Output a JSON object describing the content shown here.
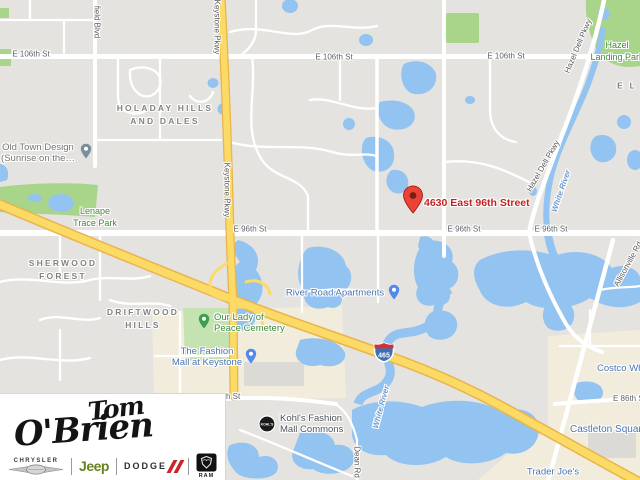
{
  "map": {
    "destination_label": "4630 East 96th Street",
    "highway_shield": "465",
    "street_labels": [
      "E 106th St",
      "E 106th St",
      "E 106th St",
      "E 96th St",
      "E 96th St",
      "E 96th St",
      "E 86th St",
      "h St"
    ],
    "road_labels": [
      "Keystone Pkwy",
      "Keystone Pkwy",
      "Hazel Dell Pkwy",
      "Hazel Dell Pkwy",
      "Allisonville Rd",
      "field Blvd",
      "Dean Rd"
    ],
    "water_labels": [
      "White River",
      "White River"
    ],
    "neighborhoods": [
      {
        "line1": "HOLADAY HILLS",
        "line2": "AND DALES"
      },
      {
        "line1": "SHERWOOD",
        "line2": "FOREST"
      },
      {
        "line1": "DRIFTWOOD",
        "line2": "HILLS"
      },
      {
        "line1": "E L",
        "line2": ""
      }
    ],
    "park_labels": [
      {
        "line1": "Hazel",
        "line2": "Landing Park"
      },
      {
        "line1": "Lenape",
        "line2": "Trace Park"
      }
    ],
    "pois": [
      {
        "line1": "Old Town Design",
        "line2": "(Sunrise on the…"
      },
      {
        "line1": "Our Lady of",
        "line2": "Peace Cemetery"
      },
      {
        "line1": "The Fashion",
        "line2": "Mall at Keystone"
      },
      {
        "line1": "River Road Apartments",
        "line2": ""
      },
      {
        "line1": "Kohl's Fashion",
        "line2": "Mall Commons"
      },
      {
        "line1": "Costco Whole",
        "line2": ""
      },
      {
        "line1": "Castleton Squar",
        "line2": ""
      },
      {
        "line1": "Trader Joe's",
        "line2": ""
      }
    ],
    "kohls_badge": "KOHL'S",
    "colors": {
      "background": "#e5e3df",
      "road": "#ffffff",
      "highway": "#fbdb65",
      "highway_casing": "#eab34c",
      "water": "#93c3f0",
      "park": "#a9d58a",
      "cemetery": "#c5e2b1",
      "commercial": "#f1ecdc",
      "street_text": "#5f6368",
      "neighborhood_text": "#828282",
      "park_text": "#44873c",
      "water_text": "#6b9bd2",
      "poi_blue_text": "#4a75b0",
      "destination_red": "#c5221f",
      "marker_red": "#ea4335",
      "shield_blue": "#3e6db5",
      "shield_red": "#ce3437"
    }
  },
  "logo": {
    "script_top": "Tom",
    "script_bottom": "O'Brien",
    "brands": {
      "chrysler": "CHRYSLER",
      "jeep": "Jeep",
      "dodge": "DODGE",
      "ram": "RAM"
    }
  }
}
